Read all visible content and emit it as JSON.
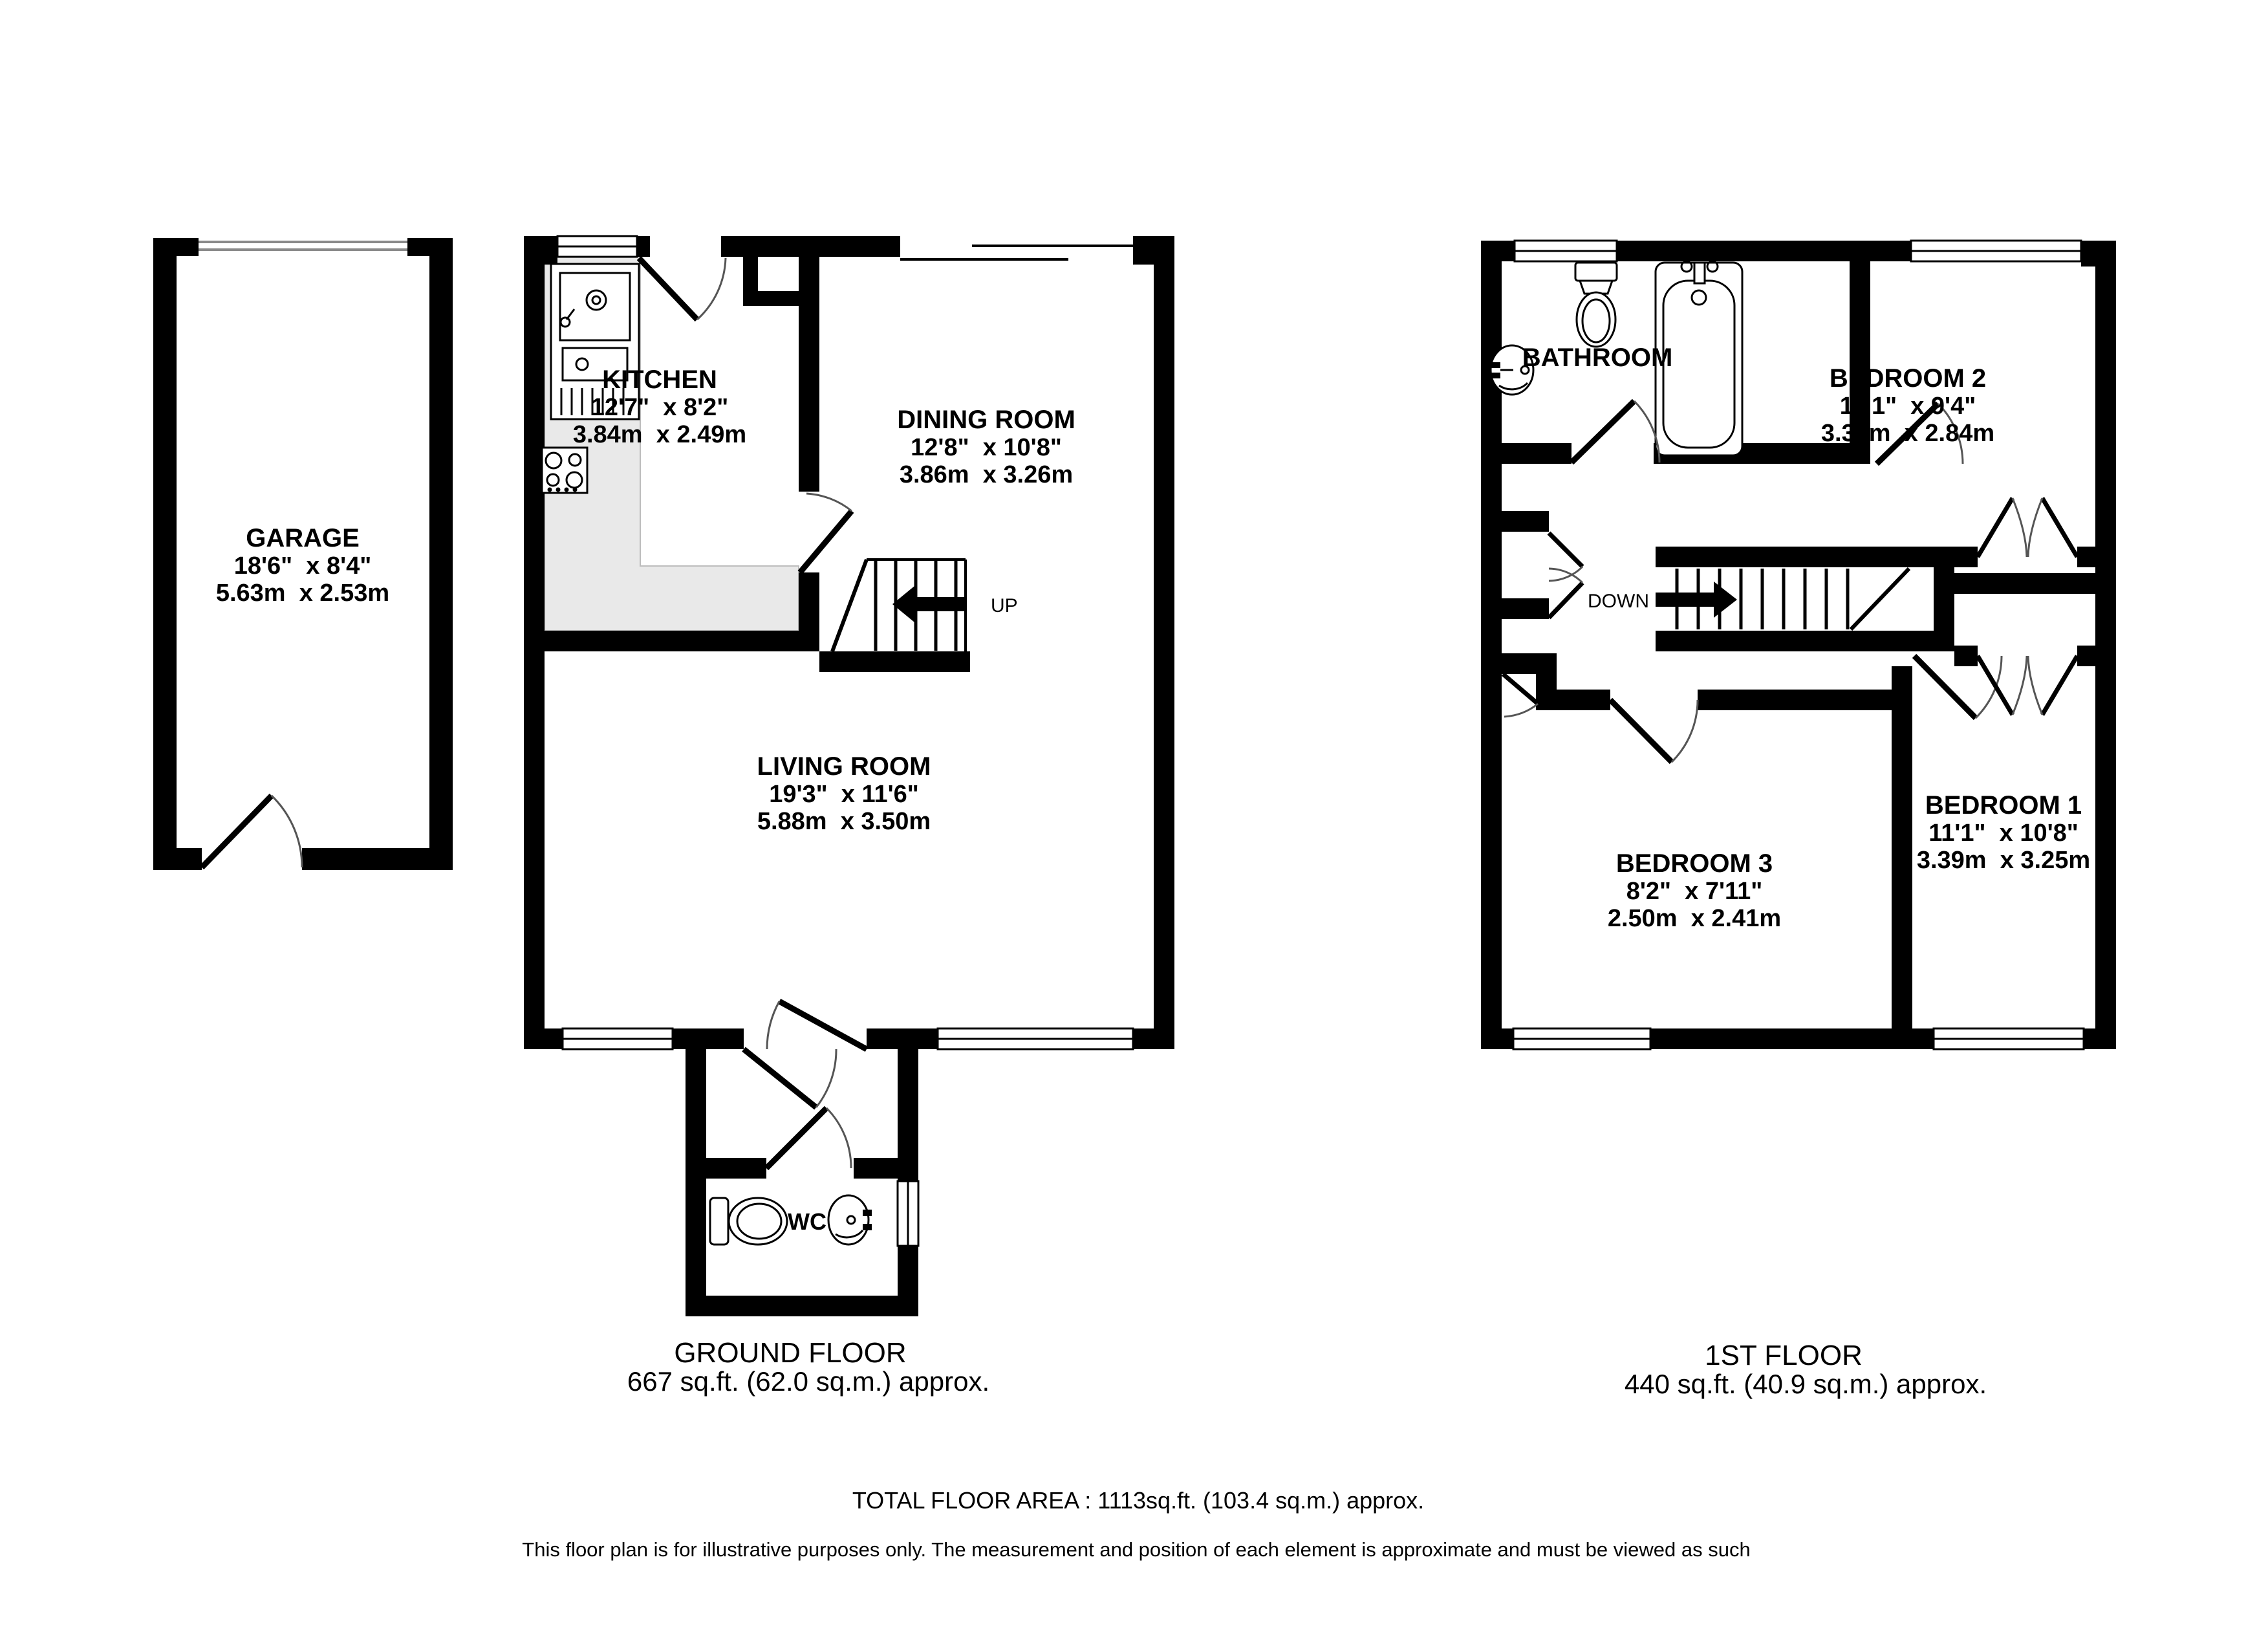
{
  "ground_floor": {
    "heading": "GROUND FLOOR",
    "area": "667 sq.ft. (62.0 sq.m.) approx.",
    "stairs_label": "UP",
    "garage": {
      "name": "GARAGE",
      "size_imperial": "18'6\"  x 8'4\"",
      "size_metric": "5.63m  x 2.53m"
    },
    "kitchen": {
      "name": "KITCHEN",
      "size_imperial": "12'7\"  x 8'2\"",
      "size_metric": "3.84m  x 2.49m"
    },
    "dining_room": {
      "name": "DINING ROOM",
      "size_imperial": "12'8\"  x 10'8\"",
      "size_metric": "3.86m  x 3.26m"
    },
    "living_room": {
      "name": "LIVING ROOM",
      "size_imperial": "19'3\"  x 11'6\"",
      "size_metric": "5.88m  x 3.50m"
    },
    "wc": {
      "name": "WC"
    }
  },
  "first_floor": {
    "heading": "1ST FLOOR",
    "area": "440 sq.ft. (40.9 sq.m.) approx.",
    "stairs_label": "DOWN",
    "bathroom": {
      "name": "BATHROOM"
    },
    "bedroom_1": {
      "name": "BEDROOM 1",
      "size_imperial": "11'1\"  x 10'8\"",
      "size_metric": "3.39m  x 3.25m"
    },
    "bedroom_2": {
      "name": "BEDROOM 2",
      "size_imperial": "11'1\"  x 9'4\"",
      "size_metric": "3.39m  x 2.84m"
    },
    "bedroom_3": {
      "name": "BEDROOM 3",
      "size_imperial": "8'2\"  x 7'11\"",
      "size_metric": "2.50m  x 2.41m"
    }
  },
  "footer": {
    "total_area": "TOTAL FLOOR AREA : 1113sq.ft. (103.4 sq.m.) approx.",
    "disclaimer": "This floor plan is for illustrative purposes only. The measurement and position of each element is approximate and must be viewed as such"
  }
}
